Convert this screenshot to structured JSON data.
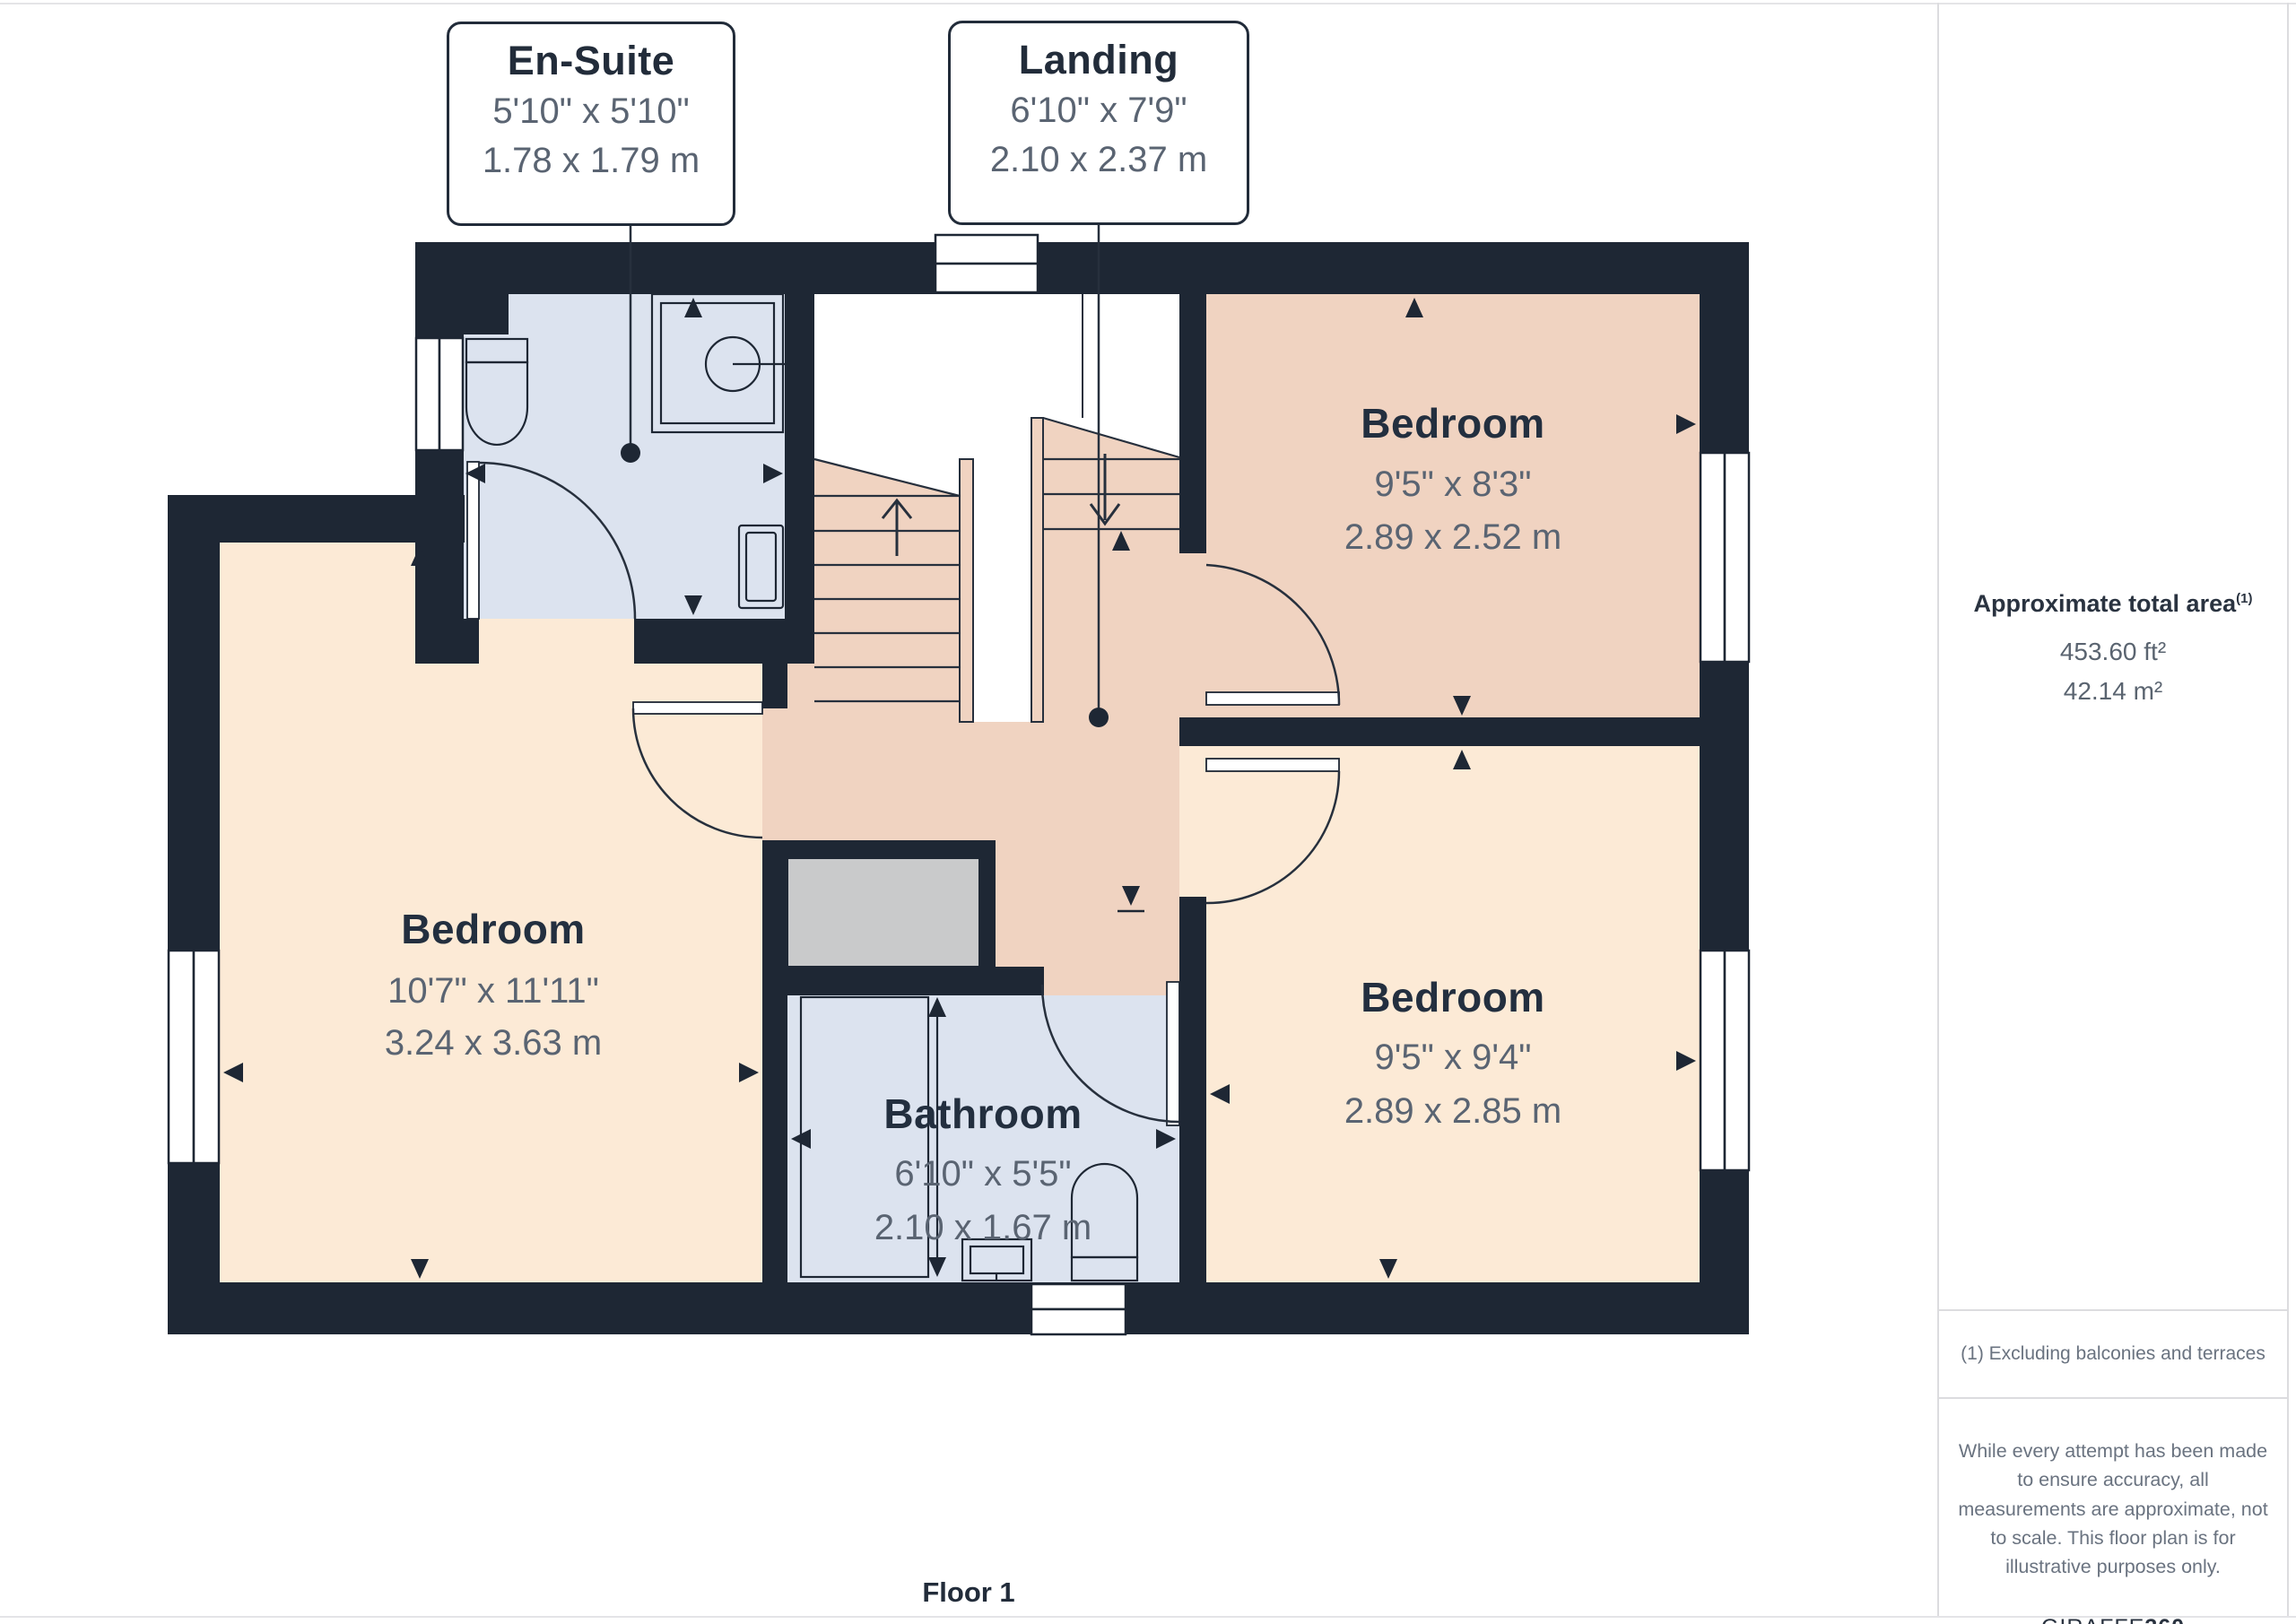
{
  "callouts": {
    "ensuite": {
      "title": "En-Suite",
      "imperial": "5'10\" x 5'10\"",
      "metric": "1.78 x 1.79 m"
    },
    "landing": {
      "title": "Landing",
      "imperial": "6'10\" x 7'9\"",
      "metric": "2.10 x 2.37 m"
    }
  },
  "rooms": {
    "bedroom_top_right": {
      "name": "Bedroom",
      "imperial": "9'5\" x 8'3\"",
      "metric": "2.89 x 2.52 m"
    },
    "bedroom_left": {
      "name": "Bedroom",
      "imperial": "10'7\" x 11'11\"",
      "metric": "3.24 x 3.63 m"
    },
    "bedroom_bottom_right": {
      "name": "Bedroom",
      "imperial": "9'5\" x 9'4\"",
      "metric": "2.89 x 2.85 m"
    },
    "bathroom": {
      "name": "Bathroom",
      "imperial": "6'10\" x 5'5\"",
      "metric": "2.10 x 1.67 m"
    }
  },
  "sidebar": {
    "title": "Approximate total area",
    "title_superscript": "(1)",
    "area_ft": "453.60 ft²",
    "area_m": "42.14 m²",
    "footnote": "(1) Excluding balconies and terraces",
    "disclaimer": "While every attempt has been made to ensure accuracy, all measurements are approximate, not to scale. This floor plan is for illustrative purposes only.",
    "brand_regular": "GIRAFFE",
    "brand_bold": "360"
  },
  "footer": {
    "floor_label": "Floor 1"
  },
  "colors": {
    "wall": "#1E2734",
    "floor_blue": "#DCE3EF",
    "floor_peach_dark": "#F0D3C1",
    "floor_peach_light": "#FCEAD6",
    "cupboard_gray": "#C9CACB",
    "label_dark": "#232F3F",
    "dim_gray": "#5A6472"
  }
}
